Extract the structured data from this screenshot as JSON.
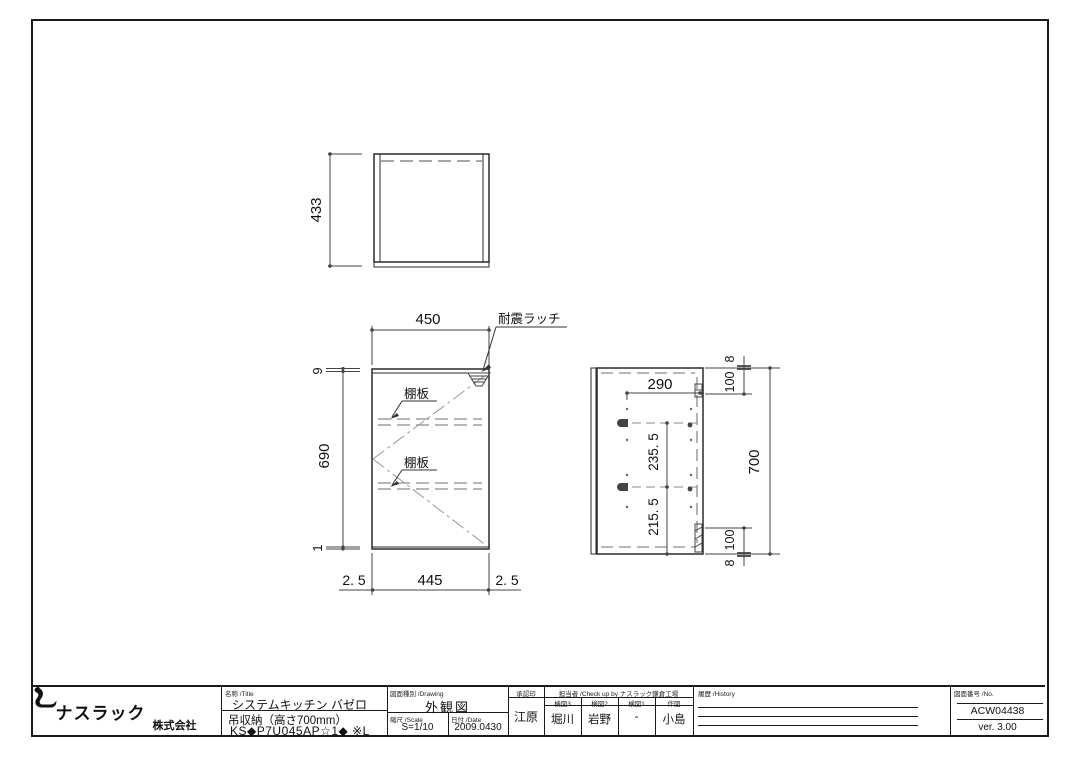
{
  "company": {
    "name_big": "ナスラック",
    "name_small": "株式会社"
  },
  "views": {
    "top": {
      "dim_depth": "433"
    },
    "front": {
      "dim_width": "450",
      "latch_label": "耐震ラッチ",
      "shelf_label": "棚板",
      "dim_top": "9",
      "dim_height": "690",
      "dim_bottom": "1",
      "gap": "2. 5",
      "door_width": "445"
    },
    "side": {
      "dim_width": "290",
      "dim_upper": "235. 5",
      "dim_lower": "215. 5",
      "dim_total": "700",
      "offset": "100",
      "panel": "8"
    }
  },
  "title_block": {
    "name_label": "名称  /Title",
    "product_line1": "システムキッチン バゼロ",
    "product_line2": "吊収納（高さ700mm）",
    "product_line3": "KS◆P7U045AP☆1◆ ※L",
    "drawing_type_label": "図面種別  /Drawing",
    "drawing_type": "外観図",
    "scale_label": "縮尺  /Scale",
    "scale": "S=1/10",
    "date_label": "日付  /Date",
    "date": "2009.0430",
    "approval_label": "承認印",
    "approver": "江原",
    "check_label": "担当者  /Check up by ナスラック鎌倉工場",
    "check_cols": [
      {
        "label": "検図3",
        "value": "堀川"
      },
      {
        "label": "検図2",
        "value": "岩野"
      },
      {
        "label": "検図1",
        "value": "-"
      },
      {
        "label": "作図",
        "value": "小島"
      }
    ],
    "history_label": "履歴  /History",
    "number_label": "図面番号  /No.",
    "number": "ACW04438",
    "version": "ver. 3.00"
  }
}
